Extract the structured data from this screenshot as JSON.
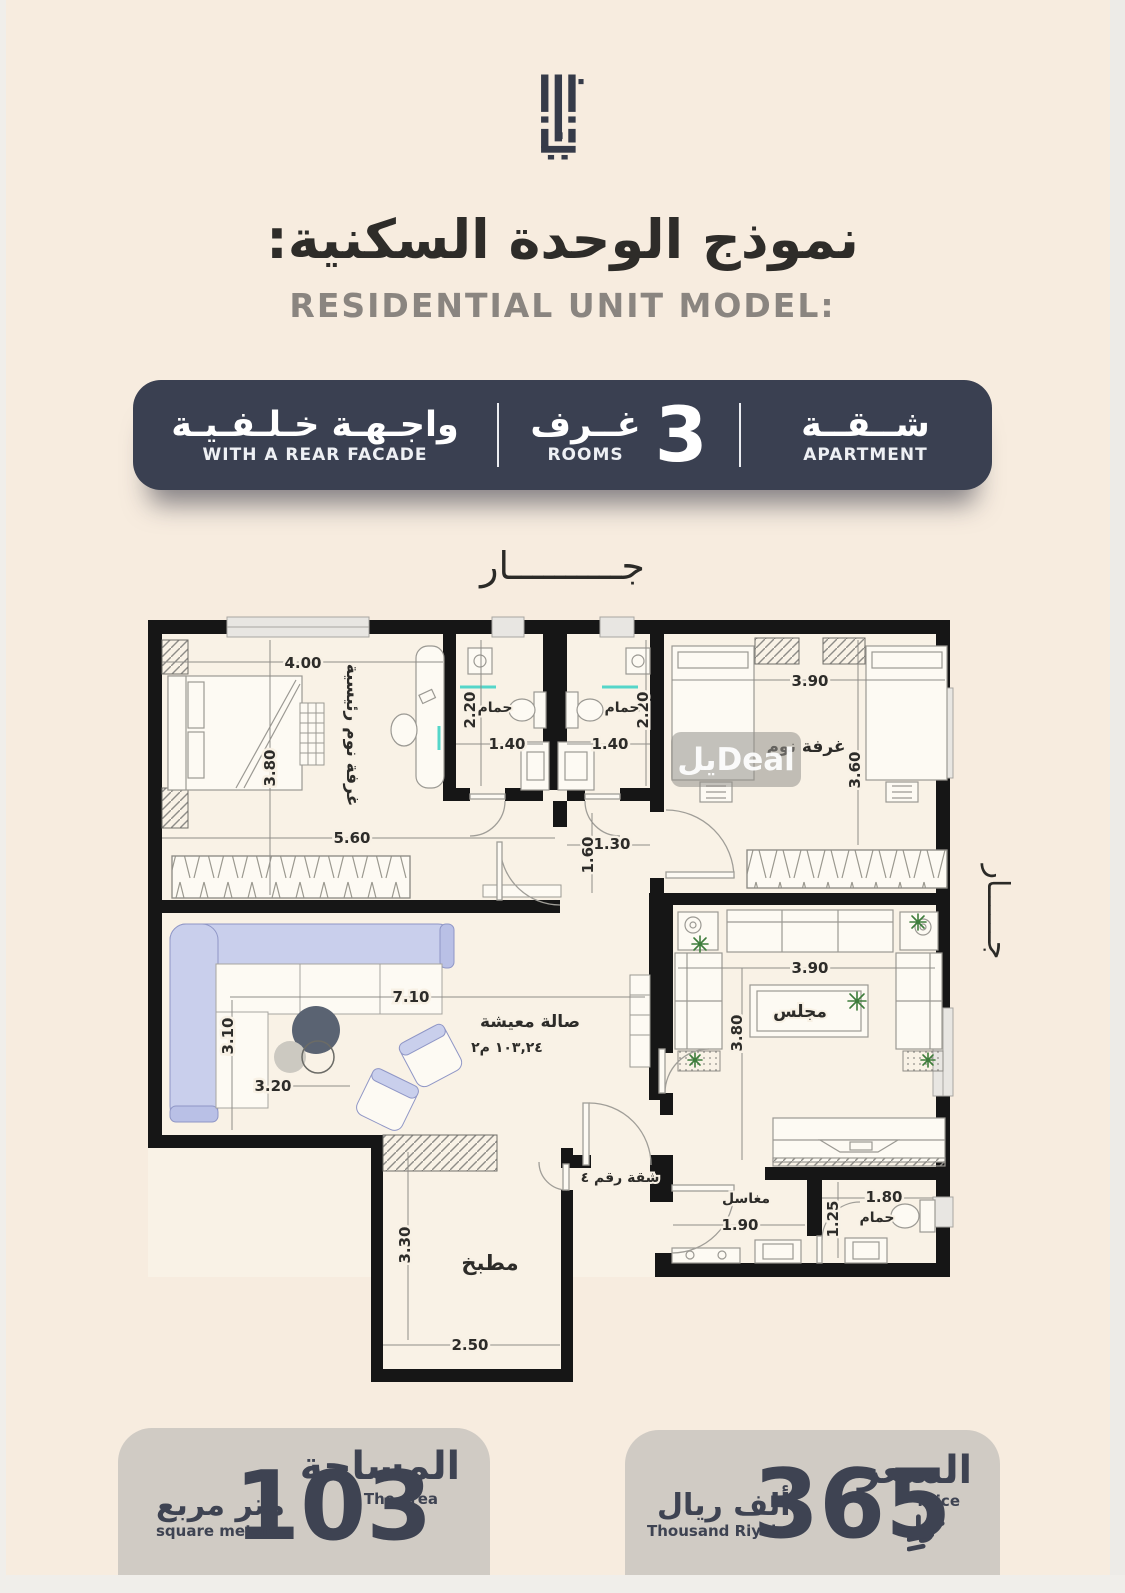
{
  "header": {
    "title_ar": "نموذج  الوحدة السكنية:",
    "title_en": "RESIDENTIAL UNIT MODEL:"
  },
  "banner": {
    "apartment": {
      "ar": "شــقــة",
      "en": "APARTMENT"
    },
    "rooms": {
      "value": "3",
      "ar": "غــرف",
      "en": "ROOMS"
    },
    "facade": {
      "ar": "واجـهـة خـلـفـيـة",
      "en": "WITH A REAR FACADE"
    }
  },
  "plan": {
    "neighbor_top": "جــــــــــار",
    "neighbor_right": "جــــــار",
    "watermark": "يلDeal",
    "labels": {
      "master_bedroom": "غرفة نوم رئيسية",
      "bathroom": "حمام",
      "bedroom": "غرفة نوم",
      "living": "صالة معيشة",
      "living_area": "١٠٣,٢٤ م٢",
      "majlis": "مجلس",
      "kitchen": "مطبخ",
      "apartment_no": "شقة رقم ٤",
      "basins": "مغاسل",
      "bathroom3": "حمام"
    },
    "dims": {
      "master_w": "4.00",
      "master_h": "3.80",
      "closet_w": "5.60",
      "bath1_h": "2.20",
      "bath1_w": "1.40",
      "bath2_h": "2.20",
      "bath2_w": "1.40",
      "hall_w": "1.30",
      "hall_h": "1.60",
      "bed2_w": "3.90",
      "bed2_h": "3.60",
      "living_w": "7.10",
      "living_h": "3.10",
      "living_w2": "3.20",
      "majlis_w": "3.90",
      "majlis_h": "3.80",
      "kitchen_h": "3.30",
      "kitchen_w": "2.50",
      "wash_w": "1.90",
      "bath3_h": "1.25",
      "bath3_w": "1.80"
    }
  },
  "footer": {
    "area": {
      "label_ar": "المساحة",
      "label_en": "The area",
      "value": "103",
      "unit_ar": "متر مربع",
      "unit_en": "square meter"
    },
    "price": {
      "label_ar": "السعر",
      "label_en": "Price",
      "value": "365",
      "unit_ar": "ألف ريال",
      "unit_en": "Thousand Riyals"
    }
  },
  "colors": {
    "background": "#f7ecdf",
    "banner": "#3a4051",
    "badge": "#d0cbc4",
    "walls": "#161616",
    "sofa": "#c9cfec",
    "teal_accent": "#55d6c9",
    "plant_green": "#3e7d3c"
  }
}
